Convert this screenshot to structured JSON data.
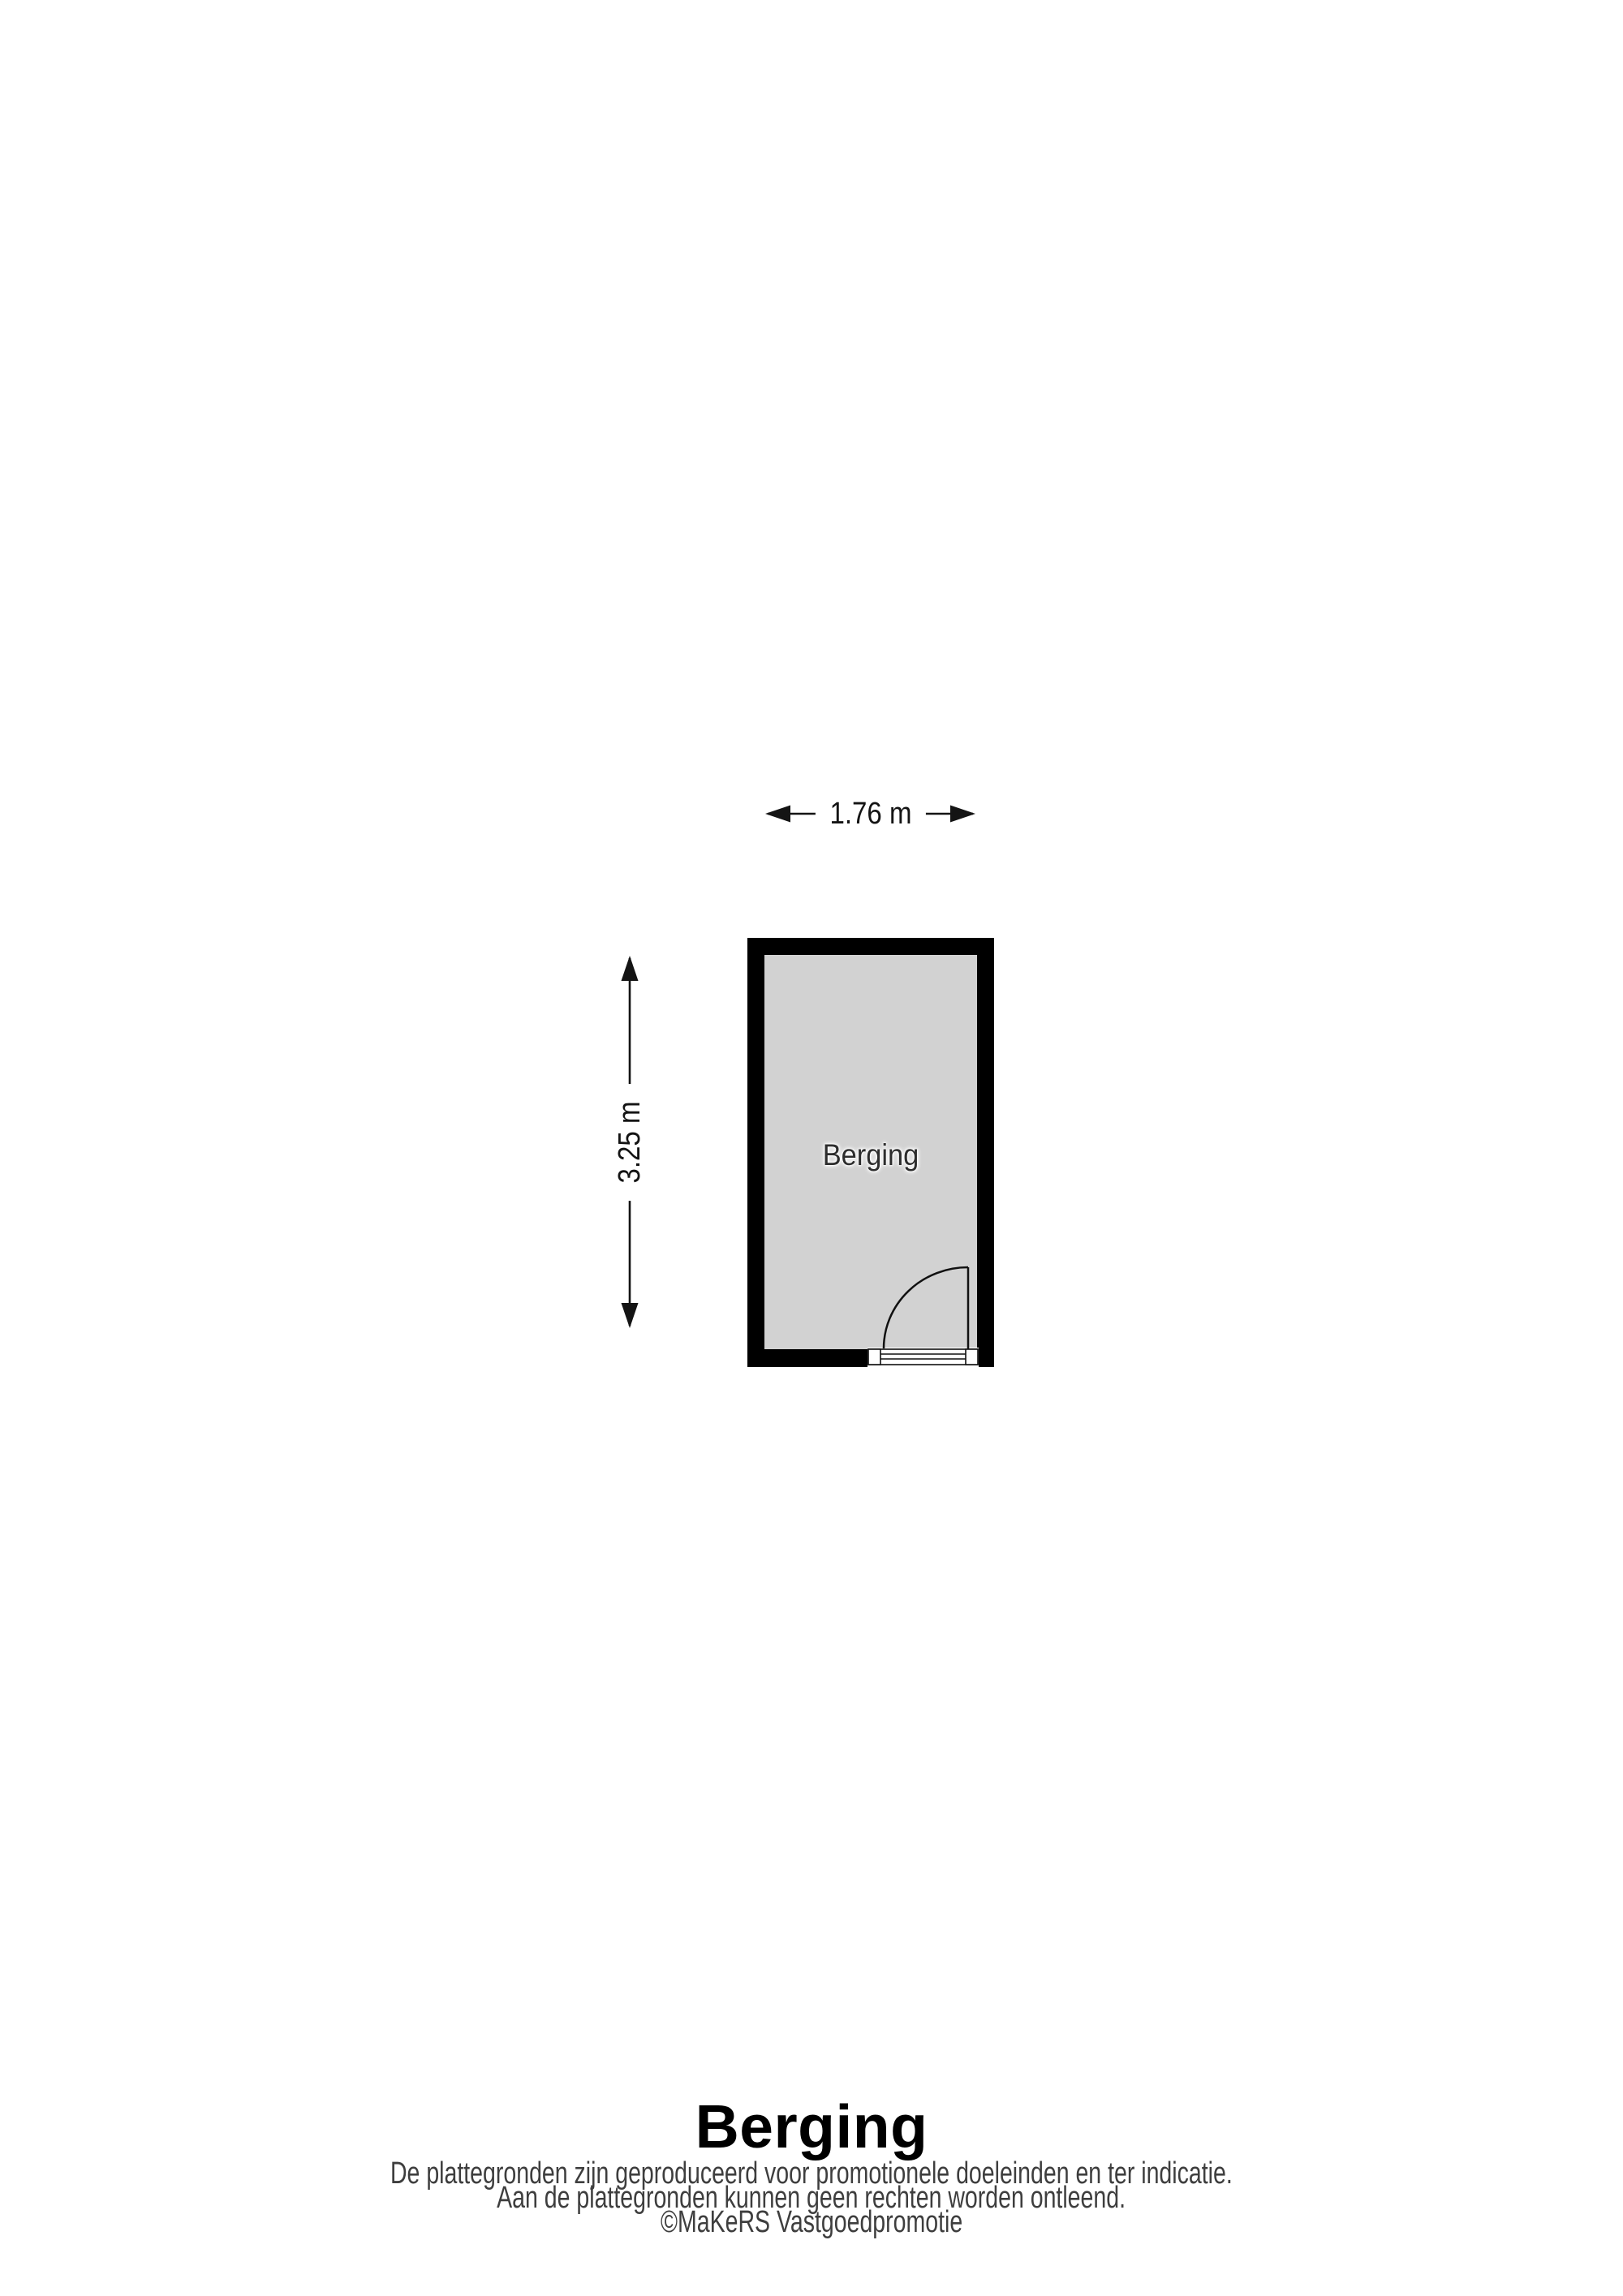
{
  "floorplan": {
    "room_label": "Berging",
    "width_dimension": "1.76 m",
    "height_dimension": "3.25 m",
    "colors": {
      "wall": "#000000",
      "floor": "#d2d2d2",
      "background": "#ffffff",
      "line": "#111111",
      "footer_text": "#3e3e3e"
    }
  },
  "footer": {
    "title": "Berging",
    "disclaimer_line1": "De plattegronden zijn geproduceerd voor promotionele doeleinden en ter indicatie.",
    "disclaimer_line2": "Aan de plattegronden kunnen geen rechten worden ontleend.",
    "credit": "©MaKeRS Vastgoedpromotie"
  }
}
